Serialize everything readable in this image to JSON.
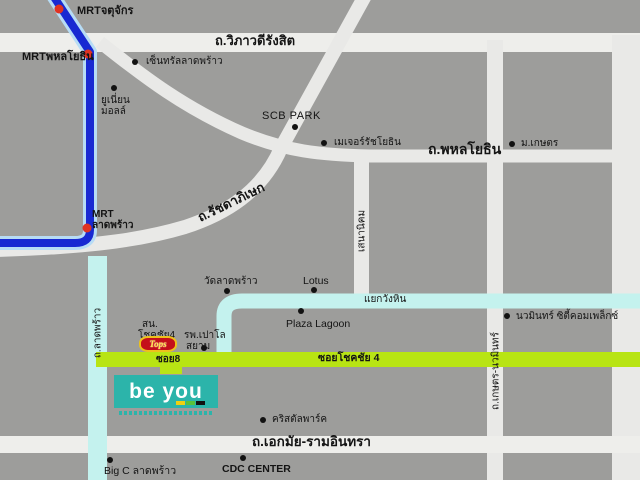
{
  "colors": {
    "background": "#9d9d9b",
    "road": "#e9e9e7",
    "major_road": "#eeeeeb",
    "cyan_road": "#c4f2ee",
    "green_road": "#b8e414",
    "mrt_line": "#1829d2",
    "mrt_casing": "#b7dcf5",
    "mrt_station": "#e03322",
    "tops_red": "#c40f1a",
    "tops_yellow": "#edc11c",
    "beyou_teal": "#2cb4aa",
    "label_text": "#141414"
  },
  "roads": {
    "vibhavadi": "ถ.วิภาวดีรังสิต",
    "phahonyothin": "ถ.พหลโยธิน",
    "ratchadaphisek": "ถ.รัชดาภิเษก",
    "senanikhom": "เสนานิคม",
    "ladprao": "ถ.ลาดพร้าว",
    "kaset_nawamin": "ถ.เกษตร-นวมินทร์",
    "yaek_wang_hin": "แยกวังหิน",
    "soi8": "ซอย8",
    "soi_chokchai4": "ซอยโชคชัย 4",
    "ekamai_ramintra": "ถ.เอกมัย-รามอินทรา"
  },
  "mrt": {
    "chatuchak": "MRTจตุจักร",
    "phahonyothin": "MRTพหลโยธิน",
    "ladprao_line1": "MRT",
    "ladprao_line2": "ลาดพร้าว"
  },
  "pois": {
    "central_ladprao": "เซ็นทรัลลาดพร้าว",
    "union_mall_line1": "ยูเนี่ยน",
    "union_mall_line2": "มอลล์",
    "scb_park": "SCB PARK",
    "major_ratchayothin": "เมเจอร์รัชโยธิน",
    "kasetsart": "ม.เกษตร",
    "wat_ladprao": "วัดลาดพร้าว",
    "lotus": "Lotus",
    "plaza_lagoon": "Plaza Lagoon",
    "nawamin_city": "นวมินทร์ ซิตี้คอมเพล็กซ์",
    "police_line1": "สน.",
    "police_line2": "โชคชัย4",
    "paolo_line1": "รพ.เปาโล",
    "paolo_line2": "สยาม",
    "crystal_park": "คริสตัลพาร์ค",
    "cdc_center": "CDC CENTER",
    "bigc_ladprao": "Big C ลาดพร้าว"
  },
  "logos": {
    "tops": "Tops",
    "beyou": "be you"
  }
}
